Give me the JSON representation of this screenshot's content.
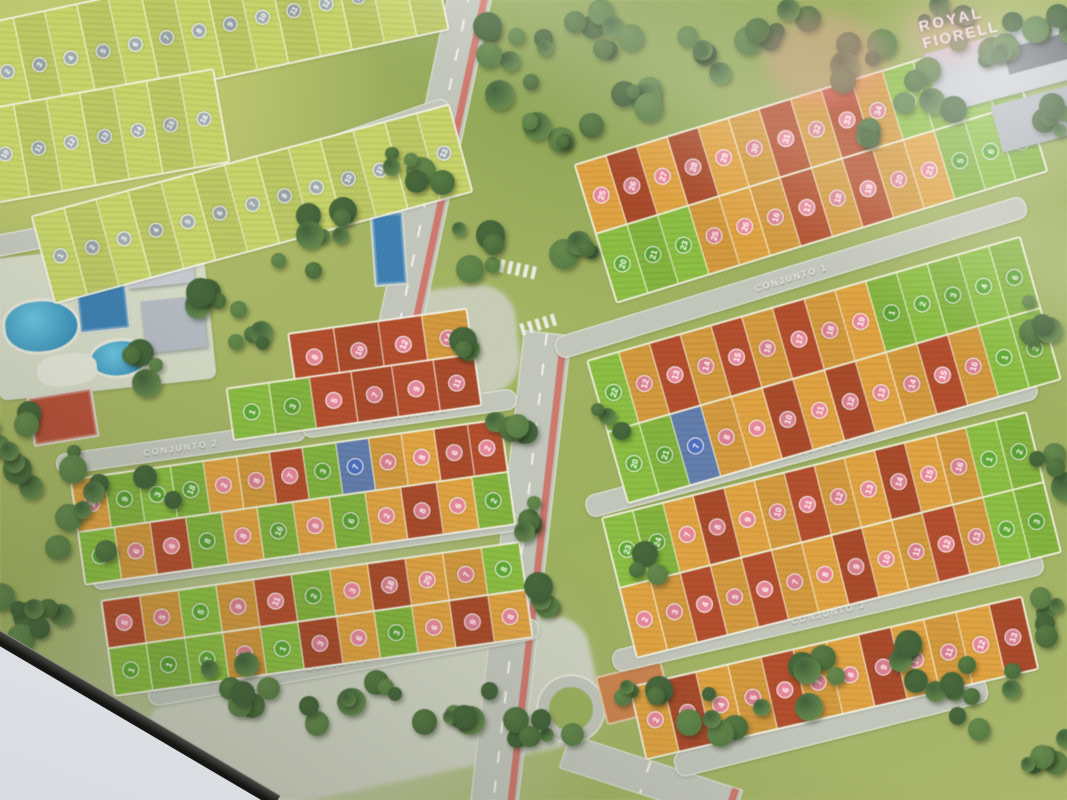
{
  "logo": {
    "line1": "ROYAL",
    "line2": "FIORELL"
  },
  "palette": {
    "lot_green": "#85b441",
    "lot_orange": "#d39a40",
    "lot_red": "#a84b2b",
    "lot_blue": "#5d77a3",
    "lot_pale": "#bcc966",
    "circle_green": "#5a9e33",
    "circle_pink": "#d7808f",
    "circle_blue": "#4a67b2",
    "circle_gray": "#97a1a4",
    "road": "#c2c6bb",
    "road_text": "#f0f2e8",
    "bike_lane": "#cf6a60",
    "water": "#4fa8c8",
    "grass": "#a3b562",
    "bezel": "#22211e",
    "wall": "#eef0f3"
  },
  "map": {
    "roads": [
      {
        "t": "CONJUNTO 1",
        "x": 790,
        "y": 276,
        "l": 490,
        "r": -17,
        "w": 21
      },
      {
        "t": "CONJUNTO 2",
        "x": 810,
        "y": 446,
        "l": 465,
        "r": -15,
        "w": 21
      },
      {
        "t": "CONJUNTO 3",
        "x": 827,
        "y": 611,
        "l": 440,
        "r": -13,
        "w": 21
      },
      {
        "t": "CONJUNTO 7",
        "x": 325,
        "y": 148,
        "l": 260,
        "r": -19,
        "w": 20
      },
      {
        "t": "CONJUNTO 6",
        "x": 130,
        "y": 219,
        "l": 290,
        "r": -11,
        "w": 20
      },
      {
        "t": "CONJUNTO 2",
        "x": 180,
        "y": 446,
        "l": 250,
        "r": -8,
        "w": 19
      },
      {
        "t": "CONJUNTO 3",
        "x": 408,
        "y": 412,
        "l": 215,
        "r": -8,
        "w": 19
      },
      {
        "t": "CONJUNTO 4",
        "x": 305,
        "y": 549,
        "l": 430,
        "r": -8,
        "w": 19
      },
      {
        "t": "CONJUNTO 5",
        "x": 342,
        "y": 661,
        "l": 395,
        "r": -10,
        "w": 20
      }
    ],
    "blocks": [
      {
        "x": 585,
        "y": 95,
        "w": 448,
        "rot": -17,
        "rh": 70,
        "rows": [
          [
            "o25",
            "r26",
            "o27",
            "r28",
            "o29",
            "o30",
            "r31",
            "o32",
            "r33",
            "o34",
            "g4",
            "g3",
            "g2",
            "g1"
          ],
          [
            "g20",
            "g21",
            "g23",
            "o25",
            "o26",
            "o16",
            "r17",
            "o18",
            "r19",
            "o20",
            "o21",
            "g5",
            "g6",
            "g7"
          ]
        ]
      },
      {
        "x": 598,
        "y": 295,
        "w": 448,
        "rot": -16,
        "rh": 72,
        "rows": [
          [
            "g22",
            "o12",
            "r13",
            "o14",
            "r15",
            "o16",
            "r17",
            "o18",
            "o19",
            "g1",
            "g2",
            "g3",
            "g4",
            "g6"
          ],
          [
            "g20",
            "g21",
            "b7",
            "o8",
            "o9",
            "r10",
            "o11",
            "r12",
            "o13",
            "o14",
            "r15",
            "o16",
            "g1",
            "g2"
          ]
        ]
      },
      {
        "x": 612,
        "y": 462,
        "w": 435,
        "rot": -14,
        "rh": 70,
        "rows": [
          [
            "g23",
            "g24",
            "o7",
            "r8",
            "o9",
            "o10",
            "r11",
            "o12",
            "o13",
            "r14",
            "o15",
            "o16",
            "g1",
            "g2"
          ],
          [
            "o2",
            "o3",
            "r4",
            "o5",
            "r6",
            "o7",
            "o8",
            "r9",
            "o10",
            "o11",
            "r12",
            "o13",
            "g2",
            "g3"
          ]
        ]
      },
      {
        "x": 632,
        "y": 640,
        "w": 400,
        "rot": -13,
        "rh": 72,
        "rows": [
          [
            "o2",
            "r3",
            "o4",
            "o5",
            "r6",
            "o7",
            "o8",
            "r9",
            "o10",
            "o11",
            "o12",
            "r13"
          ]
        ]
      },
      {
        "x": -15,
        "y": -25,
        "w": 455,
        "rot": -12,
        "rh": 100,
        "rows": [
          [
            "t2",
            "t3",
            "t4",
            "t5",
            "t6",
            "t7",
            "t8",
            "t9",
            "t10",
            "t11",
            "t12",
            "t13",
            "t14",
            "t15"
          ]
        ]
      },
      {
        "x": -15,
        "y": 88,
        "w": 235,
        "rot": -10,
        "rh": 92,
        "rows": [
          [
            "t10",
            "t11",
            "t12",
            "t13",
            "t14",
            "t15",
            "t16"
          ]
        ]
      },
      {
        "x": 35,
        "y": 158,
        "w": 430,
        "rot": -15,
        "rh": 88,
        "rows": [
          [
            "t1",
            "t2",
            "t3",
            "t4",
            "t5",
            "t6",
            "t7",
            "t8",
            "t9",
            "t10",
            "t11",
            "t12",
            "t13"
          ]
        ]
      },
      {
        "x": 290,
        "y": 320,
        "w": 178,
        "rot": -8,
        "rh": 50,
        "rows": [
          [
            "r8",
            "r10",
            "r12",
            "o14"
          ]
        ]
      },
      {
        "x": 228,
        "y": 370,
        "w": 248,
        "rot": -8,
        "rh": 50,
        "rows": [
          [
            "g1",
            "g3",
            "r5",
            "r7",
            "r9",
            "r11"
          ]
        ]
      },
      {
        "x": 75,
        "y": 448,
        "w": 432,
        "rot": -8,
        "rh": 51,
        "rows": [
          [
            "o2",
            "g9",
            "g3",
            "g18",
            "o2",
            "o8",
            "r7",
            "g3",
            "b7",
            "o2",
            "o8",
            "r6",
            "r2"
          ],
          [
            "g9",
            "o6",
            "r6",
            "g8",
            "o8",
            "g16",
            "o8",
            "g6",
            "o2",
            "r8",
            "o6",
            "g2"
          ]
        ]
      },
      {
        "x": 105,
        "y": 570,
        "w": 420,
        "rot": -8,
        "rh": 46,
        "rows": [
          [
            "r5",
            "o5",
            "g5",
            "o9",
            "r11",
            "g2",
            "o3",
            "r18",
            "o25",
            "o7",
            "g8"
          ],
          [
            "g1",
            "g1",
            "g2",
            "o3",
            "g1",
            "r3",
            "o6",
            "g3",
            "o6",
            "r9",
            "o8"
          ]
        ]
      }
    ]
  }
}
